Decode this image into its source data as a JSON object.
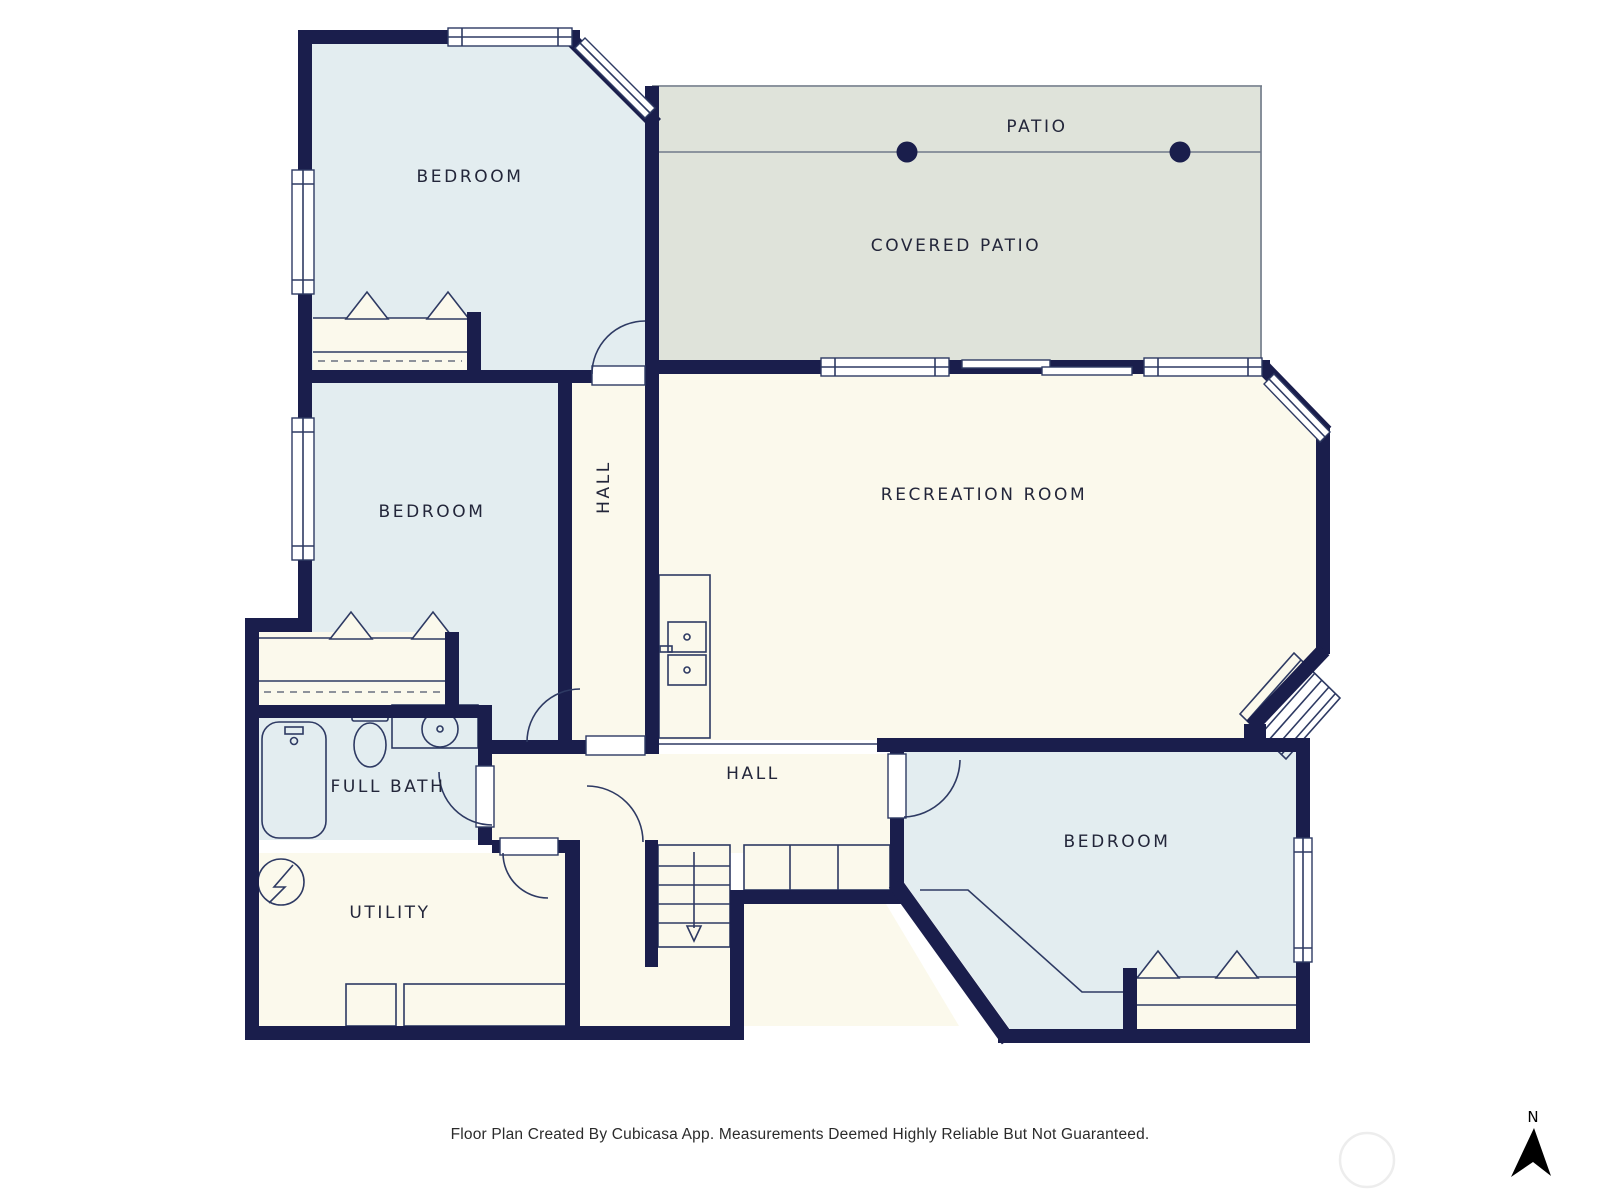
{
  "floor_plan": {
    "rooms": [
      {
        "id": "bedroom-top-left",
        "label": "BEDROOM"
      },
      {
        "id": "patio",
        "label": "PATIO"
      },
      {
        "id": "covered-patio",
        "label": "COVERED PATIO"
      },
      {
        "id": "bedroom-middle",
        "label": "BEDROOM"
      },
      {
        "id": "hall-upper",
        "label": "HALL"
      },
      {
        "id": "recreation-room",
        "label": "RECREATION ROOM"
      },
      {
        "id": "full-bath",
        "label": "FULL BATH"
      },
      {
        "id": "hall-lower",
        "label": "HALL"
      },
      {
        "id": "utility",
        "label": "UTILITY"
      },
      {
        "id": "bedroom-lower-right",
        "label": "BEDROOM"
      }
    ],
    "compass": {
      "north_label": "N"
    },
    "footer": {
      "disclaimer": "Floor Plan Created By Cubicasa App. Measurements Deemed Highly Reliable But Not Guaranteed."
    },
    "colors": {
      "wall": "#1a1e4c",
      "line": "#2e3a63",
      "room_light_blue": "#e3edf0",
      "room_cream": "#fbf9ec",
      "patio_gray": "#dfe3da",
      "patio_line": "#717a8a"
    }
  }
}
